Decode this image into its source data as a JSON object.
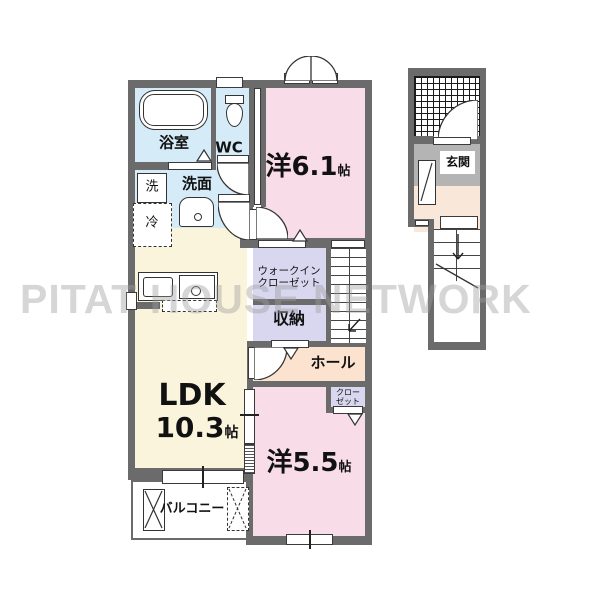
{
  "watermark": "PITAT HOUSE NETWORK",
  "colors": {
    "wall": "#6b6b6b",
    "room_pink": "#f8dce7",
    "room_blue": "#d5ebf8",
    "room_cream": "#faf4dc",
    "room_lavender": "#d8d7ef",
    "room_peach": "#fbe3d0",
    "genkan_gray": "#b4b4b4",
    "genkan_floor": "#f9e8da",
    "watermark_gray": "#9e9e9e"
  },
  "floor2": {
    "bath_label": "浴室",
    "wc_label": "WC",
    "washer_label": "洗",
    "basin_label": "洗面",
    "fridge_label": "冷",
    "western_room_1": {
      "name": "洋6.1",
      "unit": "帖"
    },
    "wic": {
      "line1": "ウォークイン",
      "line2": "クローゼット"
    },
    "storage_label": "収納",
    "hall_label": "ホール",
    "ldk": {
      "name": "LDK",
      "size": "10.3",
      "unit": "帖"
    },
    "western_room_2": {
      "name": "洋5.5",
      "unit": "帖"
    },
    "closet": {
      "line1": "クロー",
      "line2": "ゼット"
    },
    "balcony_label": "バルコニー"
  },
  "floor1": {
    "entrance_label": "玄関"
  }
}
